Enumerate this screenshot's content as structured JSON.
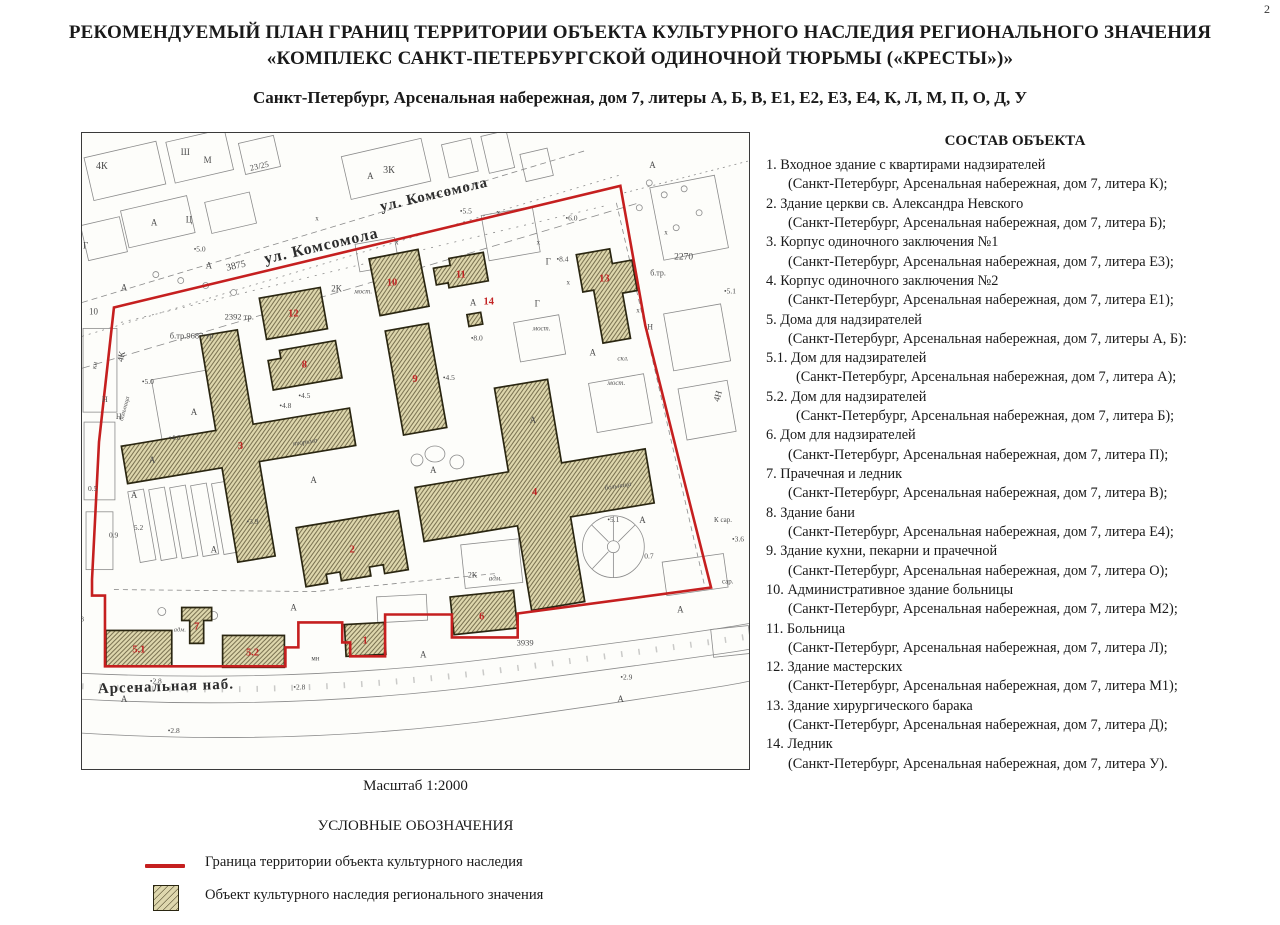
{
  "page_number": "2",
  "title": {
    "line1": "РЕКОМЕНДУЕМЫЙ ПЛАН ГРАНИЦ ТЕРРИТОРИИ ОБЪЕКТА КУЛЬТУРНОГО НАСЛЕДИЯ РЕГИОНАЛЬНОГО ЗНАЧЕНИЯ",
    "line2": "«КОМПЛЕКС САНКТ-ПЕТЕРБУРГСКОЙ ОДИНОЧНОЙ ТЮРЬМЫ («КРЕСТЫ»)»"
  },
  "subtitle": "Санкт-Петербург, Арсенальная набережная, дом 7, литеры А, Б, В, Е1, Е2, Е3, Е4, К, Л, М, П, О, Д, У",
  "scale_label": "Масштаб 1:2000",
  "legend": {
    "title": "УСЛОВНЫЕ ОБОЗНАЧЕНИЯ",
    "boundary_color": "#c51f1f",
    "hatch_fill": "#ded7ad",
    "hatch_line": "#6f6747",
    "items": [
      {
        "label": "Граница территории объекта культурного наследия"
      },
      {
        "label": "Объект культурного наследия регионального значения"
      }
    ]
  },
  "composition": {
    "title": "СОСТАВ ОБЪЕКТА",
    "items": [
      {
        "num": "1.",
        "name": "Входное здание с квартирами надзирателей",
        "addr": "(Санкт-Петербург, Арсенальная набережная, дом 7, литера К);"
      },
      {
        "num": "2.",
        "name": "Здание церкви св. Александра Невского",
        "addr": "(Санкт-Петербург, Арсенальная набережная, дом 7, литера Б);"
      },
      {
        "num": "3.",
        "name": "Корпус одиночного заключения №1",
        "addr": "(Санкт-Петербург, Арсенальная набережная, дом 7, литера Е3);"
      },
      {
        "num": "4.",
        "name": "Корпус одиночного заключения №2",
        "addr": "(Санкт-Петербург, Арсенальная набережная, дом 7, литера Е1);"
      },
      {
        "num": "5.",
        "name": "Дома для надзирателей",
        "addr": "(Санкт-Петербург, Арсенальная набережная, дом 7, литеры А, Б):"
      },
      {
        "num": "5.1.",
        "name": "Дом для надзирателей",
        "addr": "(Санкт-Петербург, Арсенальная набережная, дом 7, литера А);",
        "indent": true
      },
      {
        "num": "5.2.",
        "name": "Дом для надзирателей",
        "addr": "(Санкт-Петербург, Арсенальная набережная, дом 7, литера Б);",
        "indent": true
      },
      {
        "num": "6.",
        "name": "Дом для надзирателей",
        "addr": "(Санкт-Петербург, Арсенальная набережная, дом 7, литера П);"
      },
      {
        "num": "7.",
        "name": "Прачечная и ледник",
        "addr": "(Санкт-Петербург, Арсенальная набережная, дом 7, литера В);"
      },
      {
        "num": "8.",
        "name": "Здание бани",
        "addr": "(Санкт-Петербург, Арсенальная набережная, дом 7, литера Е4);"
      },
      {
        "num": "9.",
        "name": "Здание кухни, пекарни и прачечной",
        "addr": "(Санкт-Петербург, Арсенальная набережная, дом 7, литера О);"
      },
      {
        "num": "10.",
        "name": "Административное здание больницы",
        "addr": "(Санкт-Петербург, Арсенальная набережная, дом 7, литера М2);"
      },
      {
        "num": "11.",
        "name": "Больница",
        "addr": "(Санкт-Петербург, Арсенальная набережная, дом 7, литера Л);"
      },
      {
        "num": "12.",
        "name": "Здание мастерских",
        "addr": "(Санкт-Петербург, Арсенальная набережная, дом 7, литера М1);"
      },
      {
        "num": "13.",
        "name": "Здание хирургического барака",
        "addr": "(Санкт-Петербург, Арсенальная набережная, дом 7, литера Д);"
      },
      {
        "num": "14.",
        "name": "Ледник",
        "addr": "(Санкт-Петербург, Арсенальная набережная, дом 7, литера У)."
      }
    ]
  },
  "map": {
    "labels": [
      {
        "k": "street",
        "t": "ул. Комсомола",
        "x": 257,
        "y": 128,
        "r": -13,
        "s": 16,
        "a": "middle"
      },
      {
        "k": "street",
        "t": "ул. Комсомола",
        "x": 370,
        "y": 76,
        "r": -13,
        "s": 15,
        "a": "middle"
      },
      {
        "k": "street",
        "t": "Арсенальная наб.",
        "x": 32,
        "y": 572,
        "r": -2,
        "s": 15
      },
      {
        "k": "bnum",
        "t": "1",
        "x": 300,
        "y": 522,
        "s": 10.5,
        "a": "middle"
      },
      {
        "k": "bnum",
        "t": "2",
        "x": 287,
        "y": 431,
        "s": 10.5,
        "a": "middle"
      },
      {
        "k": "bnum",
        "t": "3",
        "x": 175,
        "y": 327,
        "s": 10.5,
        "a": "middle"
      },
      {
        "k": "bnum",
        "t": "4",
        "x": 470,
        "y": 373,
        "s": 10.5,
        "a": "middle"
      },
      {
        "k": "bnum",
        "t": "5.1",
        "x": 73,
        "y": 531,
        "s": 10.5,
        "a": "middle"
      },
      {
        "k": "bnum",
        "t": "5.2",
        "x": 187,
        "y": 534,
        "s": 10.5,
        "a": "middle"
      },
      {
        "k": "bnum",
        "t": "6",
        "x": 417,
        "y": 498,
        "s": 10.5,
        "a": "middle"
      },
      {
        "k": "bnum",
        "t": "7",
        "x": 131,
        "y": 508,
        "s": 10.5,
        "a": "middle"
      },
      {
        "k": "bnum",
        "t": "8",
        "x": 239,
        "y": 245,
        "s": 10.5,
        "a": "middle"
      },
      {
        "k": "bnum",
        "t": "9",
        "x": 350,
        "y": 260,
        "s": 10.5,
        "a": "middle"
      },
      {
        "k": "bnum",
        "t": "10",
        "x": 327,
        "y": 163,
        "s": 10.5,
        "a": "middle"
      },
      {
        "k": "bnum",
        "t": "11",
        "x": 396,
        "y": 155,
        "s": 10.5,
        "a": "middle"
      },
      {
        "k": "bnum",
        "t": "12",
        "x": 228,
        "y": 194,
        "s": 10.5,
        "a": "middle"
      },
      {
        "k": "bnum",
        "t": "13",
        "x": 540,
        "y": 159,
        "s": 10.5,
        "a": "middle"
      },
      {
        "k": "bnum",
        "t": "14",
        "x": 424,
        "y": 182,
        "s": 10.5,
        "a": "middle"
      },
      {
        "k": "ann",
        "t": "3875",
        "x": 171,
        "y": 146,
        "r": -13,
        "s": 10,
        "a": "middle"
      },
      {
        "k": "ann",
        "t": "23/25",
        "x": 185,
        "y": 48,
        "r": -13,
        "s": 8.5
      },
      {
        "k": "ann",
        "t": "2392 тр.",
        "x": 159,
        "y": 197,
        "s": 8.5
      },
      {
        "k": "ann",
        "t": "б.тр.9687 тр",
        "x": 104,
        "y": 216,
        "s": 8.5
      },
      {
        "k": "ann",
        "t": "2270",
        "x": 610,
        "y": 137,
        "s": 9.5
      },
      {
        "k": "ann",
        "t": "б.тр.",
        "x": 586,
        "y": 153,
        "s": 8
      },
      {
        "k": "ann",
        "t": "3939",
        "x": 452,
        "y": 524,
        "s": 8.5
      },
      {
        "k": "ann",
        "t": "4К",
        "x": 30,
        "y": 46,
        "s": 10
      },
      {
        "k": "ann",
        "t": "Ш",
        "x": 115,
        "y": 32,
        "s": 9
      },
      {
        "k": "ann",
        "t": "М",
        "x": 138,
        "y": 40,
        "s": 9
      },
      {
        "k": "ann",
        "t": "3К",
        "x": 318,
        "y": 50,
        "s": 10
      },
      {
        "k": "ann",
        "t": "Ц",
        "x": 120,
        "y": 100,
        "s": 9
      },
      {
        "k": "ann",
        "t": "Г",
        "x": 17,
        "y": 126,
        "s": 9
      },
      {
        "k": "ann",
        "t": "4К",
        "x": 57,
        "y": 240,
        "r": -78,
        "s": 9
      },
      {
        "k": "ann",
        "t": "кн",
        "x": 30,
        "y": 247,
        "r": -80,
        "s": 7
      },
      {
        "k": "anni",
        "t": "больница",
        "x": 57,
        "y": 299,
        "r": -75,
        "s": 6.5
      },
      {
        "k": "ann",
        "t": "2К",
        "x": 266,
        "y": 169,
        "s": 9
      },
      {
        "k": "anni",
        "t": "мост.",
        "x": 289,
        "y": 171,
        "s": 7
      },
      {
        "k": "anni",
        "t": "мост.",
        "x": 468,
        "y": 208,
        "s": 7
      },
      {
        "k": "anni",
        "t": "скл.",
        "x": 553,
        "y": 238,
        "s": 7
      },
      {
        "k": "anni",
        "t": "мост.",
        "x": 543,
        "y": 263,
        "s": 7
      },
      {
        "k": "anni",
        "t": "тюрьма",
        "x": 240,
        "y": 322,
        "r": -9,
        "s": 7,
        "a": "middle"
      },
      {
        "k": "anni",
        "t": "больница",
        "x": 554,
        "y": 366,
        "r": -9,
        "s": 7,
        "a": "middle"
      },
      {
        "k": "ann",
        "t": "Г",
        "x": 481,
        "y": 142,
        "s": 9
      },
      {
        "k": "ann",
        "t": "•8.4",
        "x": 492,
        "y": 139,
        "s": 7.5
      },
      {
        "k": "ann",
        "t": "Г",
        "x": 470,
        "y": 184,
        "s": 9
      },
      {
        "k": "ann",
        "t": "•8.0",
        "x": 406,
        "y": 218,
        "s": 7.5
      },
      {
        "k": "ann",
        "t": "•5.5",
        "x": 395,
        "y": 91,
        "s": 7.5
      },
      {
        "k": "ann",
        "t": "•4.5",
        "x": 378,
        "y": 258,
        "s": 7.5
      },
      {
        "k": "ann",
        "t": "•4.5",
        "x": 233,
        "y": 276,
        "s": 7.5
      },
      {
        "k": "ann",
        "t": "•4.8",
        "x": 214,
        "y": 286,
        "s": 7.5
      },
      {
        "k": "ann",
        "t": "•4.8",
        "x": 103,
        "y": 318,
        "s": 7.5
      },
      {
        "k": "ann",
        "t": "•3.9",
        "x": 181,
        "y": 402,
        "s": 7.5
      },
      {
        "k": "ann",
        "t": "0.5",
        "x": 22,
        "y": 369,
        "s": 7.5
      },
      {
        "k": "ann",
        "t": "0.9",
        "x": 43,
        "y": 416,
        "s": 7.5
      },
      {
        "k": "ann",
        "t": "5.2",
        "x": 68,
        "y": 408,
        "s": 7.5
      },
      {
        "k": "ann",
        "t": "•5.1",
        "x": 543,
        "y": 400,
        "s": 7.5
      },
      {
        "k": "ann",
        "t": "0.7",
        "x": 580,
        "y": 437,
        "s": 7.5
      },
      {
        "k": "ann",
        "t": "•5.1",
        "x": 660,
        "y": 171,
        "s": 7.5
      },
      {
        "k": "ann",
        "t": "•6.0",
        "x": 501,
        "y": 98,
        "s": 7.5
      },
      {
        "k": "ann",
        "t": "•5.0",
        "x": 128,
        "y": 129,
        "s": 7.5
      },
      {
        "k": "ann",
        "t": "•5.0",
        "x": 76,
        "y": 262,
        "s": 7.5
      },
      {
        "k": "ann",
        "t": "•3.6",
        "x": 668,
        "y": 420,
        "s": 7.5
      },
      {
        "k": "ann",
        "t": "К сар.",
        "x": 650,
        "y": 400,
        "s": 7
      },
      {
        "k": "ann",
        "t": "сар.",
        "x": 658,
        "y": 462,
        "s": 7
      },
      {
        "k": "ann",
        "t": "окр",
        "x": 3,
        "y": 482,
        "s": 6.5
      },
      {
        "k": "ann",
        "t": "•2.8",
        "x": 6,
        "y": 500,
        "s": 7.5
      },
      {
        "k": "ann",
        "t": "•2.8",
        "x": 84,
        "y": 562,
        "s": 7.5
      },
      {
        "k": "ann",
        "t": "•2.8",
        "x": 228,
        "y": 568,
        "s": 7.5
      },
      {
        "k": "ann",
        "t": "•2.8",
        "x": 102,
        "y": 612,
        "s": 7.5
      },
      {
        "k": "ann",
        "t": "•2.9",
        "x": 556,
        "y": 558,
        "s": 7.5
      },
      {
        "k": "ann",
        "t": "2К",
        "x": 403,
        "y": 456,
        "s": 8
      },
      {
        "k": "anni",
        "t": "адм.",
        "x": 424,
        "y": 459,
        "s": 7
      },
      {
        "k": "anni",
        "t": "адм.",
        "x": 108,
        "y": 510,
        "s": 6.5
      },
      {
        "k": "ann",
        "t": "мн",
        "x": 246,
        "y": 539,
        "s": 7
      },
      {
        "k": "ann",
        "t": "4Н",
        "x": 655,
        "y": 280,
        "r": -75,
        "s": 9
      },
      {
        "k": "ann",
        "t": "Н",
        "x": 36,
        "y": 280,
        "s": 8
      },
      {
        "k": "ann",
        "t": "Н",
        "x": 50,
        "y": 297,
        "s": 8
      },
      {
        "k": "ann",
        "t": "Н",
        "x": 583,
        "y": 207,
        "s": 8
      },
      {
        "k": "ann",
        "t": "10",
        "x": 23,
        "y": 192,
        "s": 9
      },
      {
        "k": "ann",
        "t": "А",
        "x": 85,
        "y": 103,
        "s": 9
      },
      {
        "k": "ann",
        "t": "А",
        "x": 140,
        "y": 146,
        "s": 9
      },
      {
        "k": "ann",
        "t": "А",
        "x": 55,
        "y": 168,
        "s": 9
      },
      {
        "k": "ann",
        "t": "А",
        "x": 125,
        "y": 293,
        "s": 9
      },
      {
        "k": "ann",
        "t": "А",
        "x": 83,
        "y": 341,
        "s": 9
      },
      {
        "k": "ann",
        "t": "А",
        "x": 65,
        "y": 376,
        "s": 9
      },
      {
        "k": "ann",
        "t": "А",
        "x": 145,
        "y": 431,
        "s": 9
      },
      {
        "k": "ann",
        "t": "А",
        "x": 245,
        "y": 361,
        "s": 9
      },
      {
        "k": "ann",
        "t": "А",
        "x": 365,
        "y": 351,
        "s": 9
      },
      {
        "k": "ann",
        "t": "А",
        "x": 465,
        "y": 301,
        "s": 9
      },
      {
        "k": "ann",
        "t": "А",
        "x": 405,
        "y": 183,
        "s": 9
      },
      {
        "k": "ann",
        "t": "А",
        "x": 525,
        "y": 233,
        "s": 9
      },
      {
        "k": "ann",
        "t": "А",
        "x": 575,
        "y": 401,
        "s": 9
      },
      {
        "k": "ann",
        "t": "А",
        "x": 613,
        "y": 491,
        "s": 9
      },
      {
        "k": "ann",
        "t": "А",
        "x": 355,
        "y": 536,
        "s": 9
      },
      {
        "k": "ann",
        "t": "А",
        "x": 55,
        "y": 581,
        "s": 9
      },
      {
        "k": "ann",
        "t": "А",
        "x": 553,
        "y": 581,
        "s": 9
      },
      {
        "k": "ann",
        "t": "А",
        "x": 225,
        "y": 489,
        "s": 9
      },
      {
        "k": "ann",
        "t": "А",
        "x": 585,
        "y": 45,
        "s": 9
      },
      {
        "k": "ann",
        "t": "А",
        "x": 302,
        "y": 56,
        "s": 9
      },
      {
        "k": "ann",
        "t": "х",
        "x": 250,
        "y": 98,
        "s": 7
      },
      {
        "k": "ann",
        "t": "х",
        "x": 330,
        "y": 122,
        "s": 7
      },
      {
        "k": "ann",
        "t": "х",
        "x": 472,
        "y": 122,
        "s": 7
      },
      {
        "k": "ann",
        "t": "х",
        "x": 502,
        "y": 162,
        "s": 7
      },
      {
        "k": "ann",
        "t": "х",
        "x": 432,
        "y": 92,
        "s": 7
      },
      {
        "k": "ann",
        "t": "х",
        "x": 600,
        "y": 112,
        "s": 7
      },
      {
        "k": "ann",
        "t": "х",
        "x": 572,
        "y": 190,
        "s": 7
      }
    ]
  }
}
